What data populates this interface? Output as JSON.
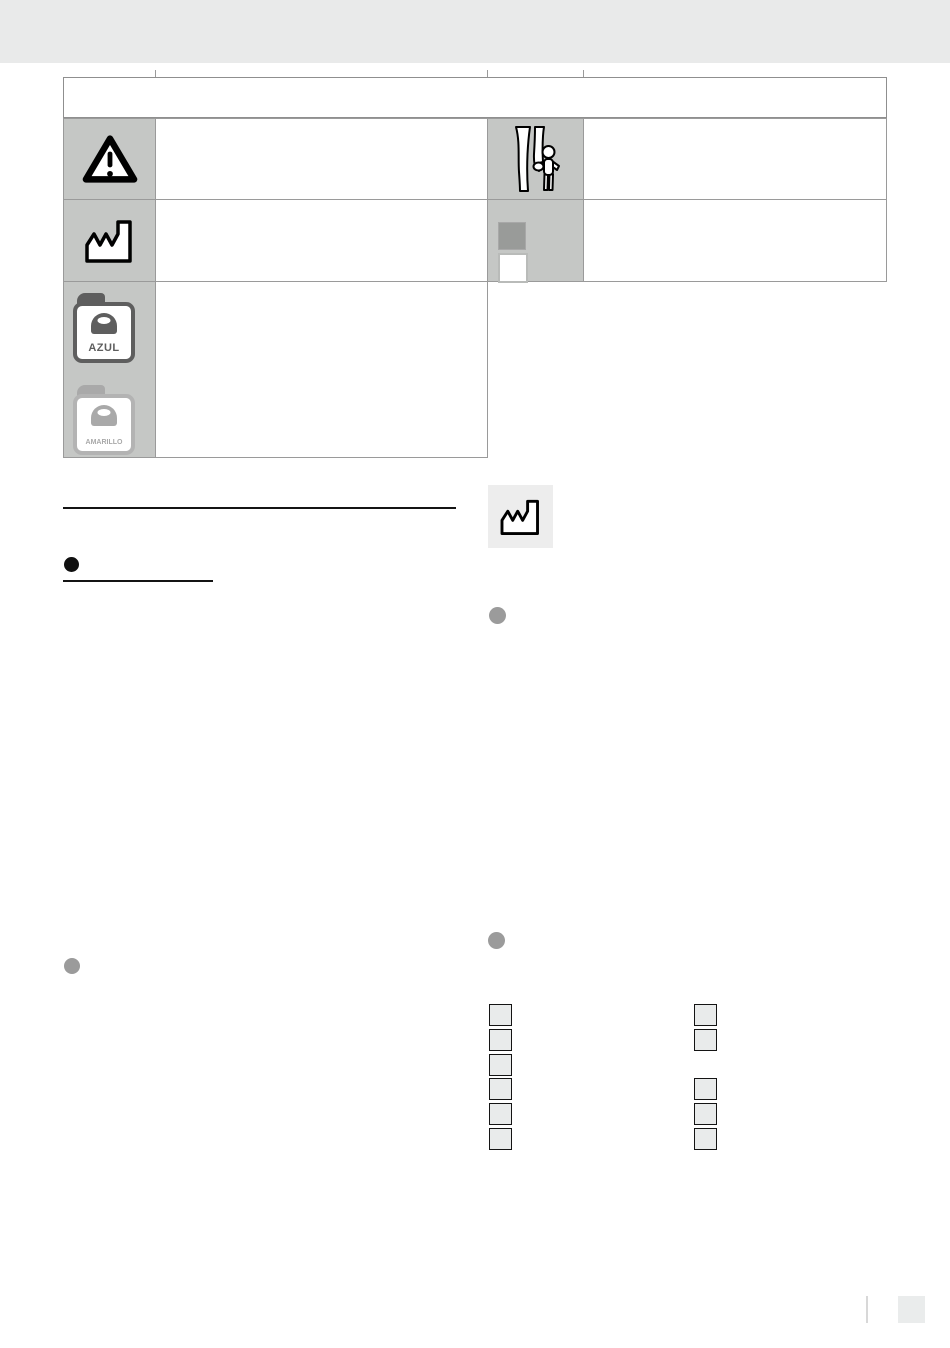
{
  "page": {
    "width": 950,
    "height": 1348,
    "background": "#ffffff"
  },
  "header_band": {
    "color": "#e9eaea"
  },
  "symbols_table": {
    "title_text": "",
    "icon_cell_background": "#c5c7c5",
    "border_color": "#9a9a9a",
    "icons": [
      {
        "name": "warning-triangle-icon",
        "row": 1,
        "column": "left",
        "description_text": ""
      },
      {
        "name": "keep-away-from-children-icon",
        "row": 1,
        "column": "right",
        "description_text": ""
      },
      {
        "name": "manufacturer-factory-icon",
        "row": 2,
        "column": "left",
        "description_text": ""
      },
      {
        "name": "gray-white-squares-icon",
        "row": 2,
        "column": "right",
        "description_text": ""
      },
      {
        "name": "oil-canisters-icon",
        "row": 3,
        "column": "left",
        "description_text": ""
      }
    ]
  },
  "canisters": {
    "blue": {
      "label": "AZUL",
      "color": "#5e5e5e"
    },
    "yellow": {
      "label": "AMARILLO",
      "color": "#a9a9a9"
    }
  },
  "body_content": {
    "section_heading_text": "",
    "subheading_text": "",
    "black_bullet_color": "#101010",
    "gray_bullet_color": "#9b9b9b",
    "manufacture_icon_box_background": "#ededed"
  },
  "checklists": {
    "box_fill": "#e9ebeb",
    "box_border": "#141414",
    "left_column": [
      true,
      true,
      true,
      true,
      true,
      true
    ],
    "right_column": [
      true,
      true,
      false,
      true,
      true,
      true
    ]
  },
  "footer": {
    "page_number_text": "",
    "box_color": "#eaecec",
    "divider_color": "#d8d8d8"
  }
}
